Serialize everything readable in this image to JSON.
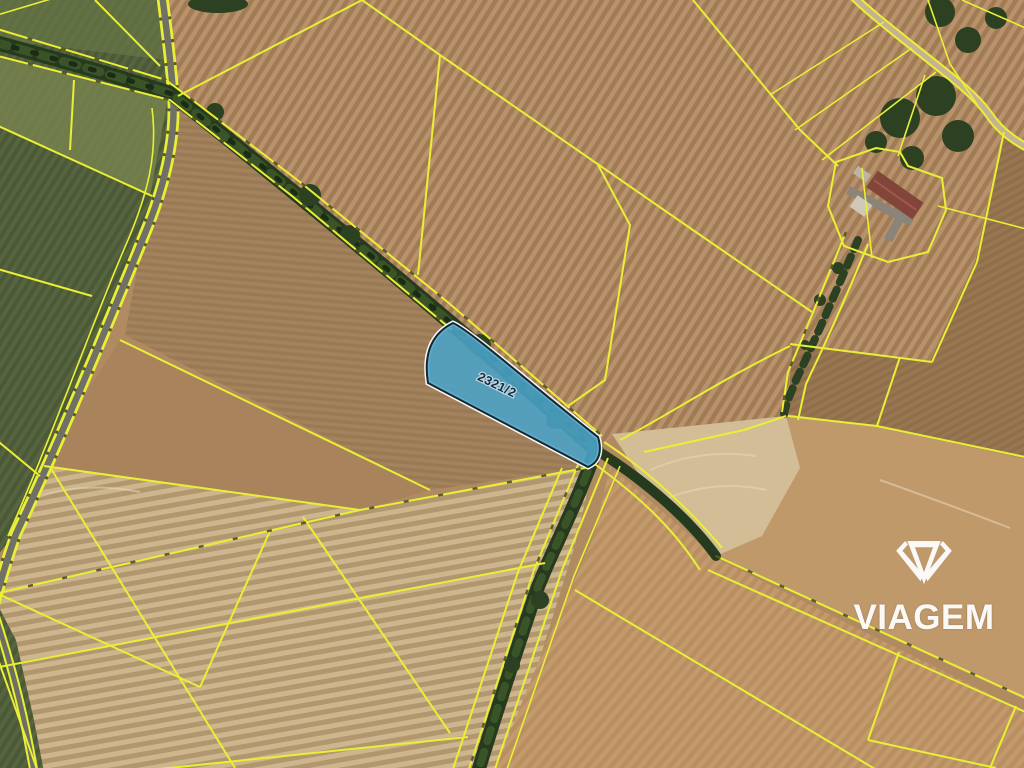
{
  "map": {
    "kind": "cadastral-satellite-view",
    "highlighted_parcel": {
      "label": "2321/2",
      "fill": "#4aa3c8",
      "border": "#16262e",
      "halo": "#ffffff"
    },
    "lines": {
      "parcel_boundary": "#e9ef35"
    },
    "terrain": {
      "field_tan": "#b08a60",
      "field_green": "#4c5936",
      "tree_line": "#263a1e",
      "road_gray": "#707066"
    },
    "watermark": {
      "brand": "VIAGEM",
      "color": "#ffffff"
    }
  }
}
